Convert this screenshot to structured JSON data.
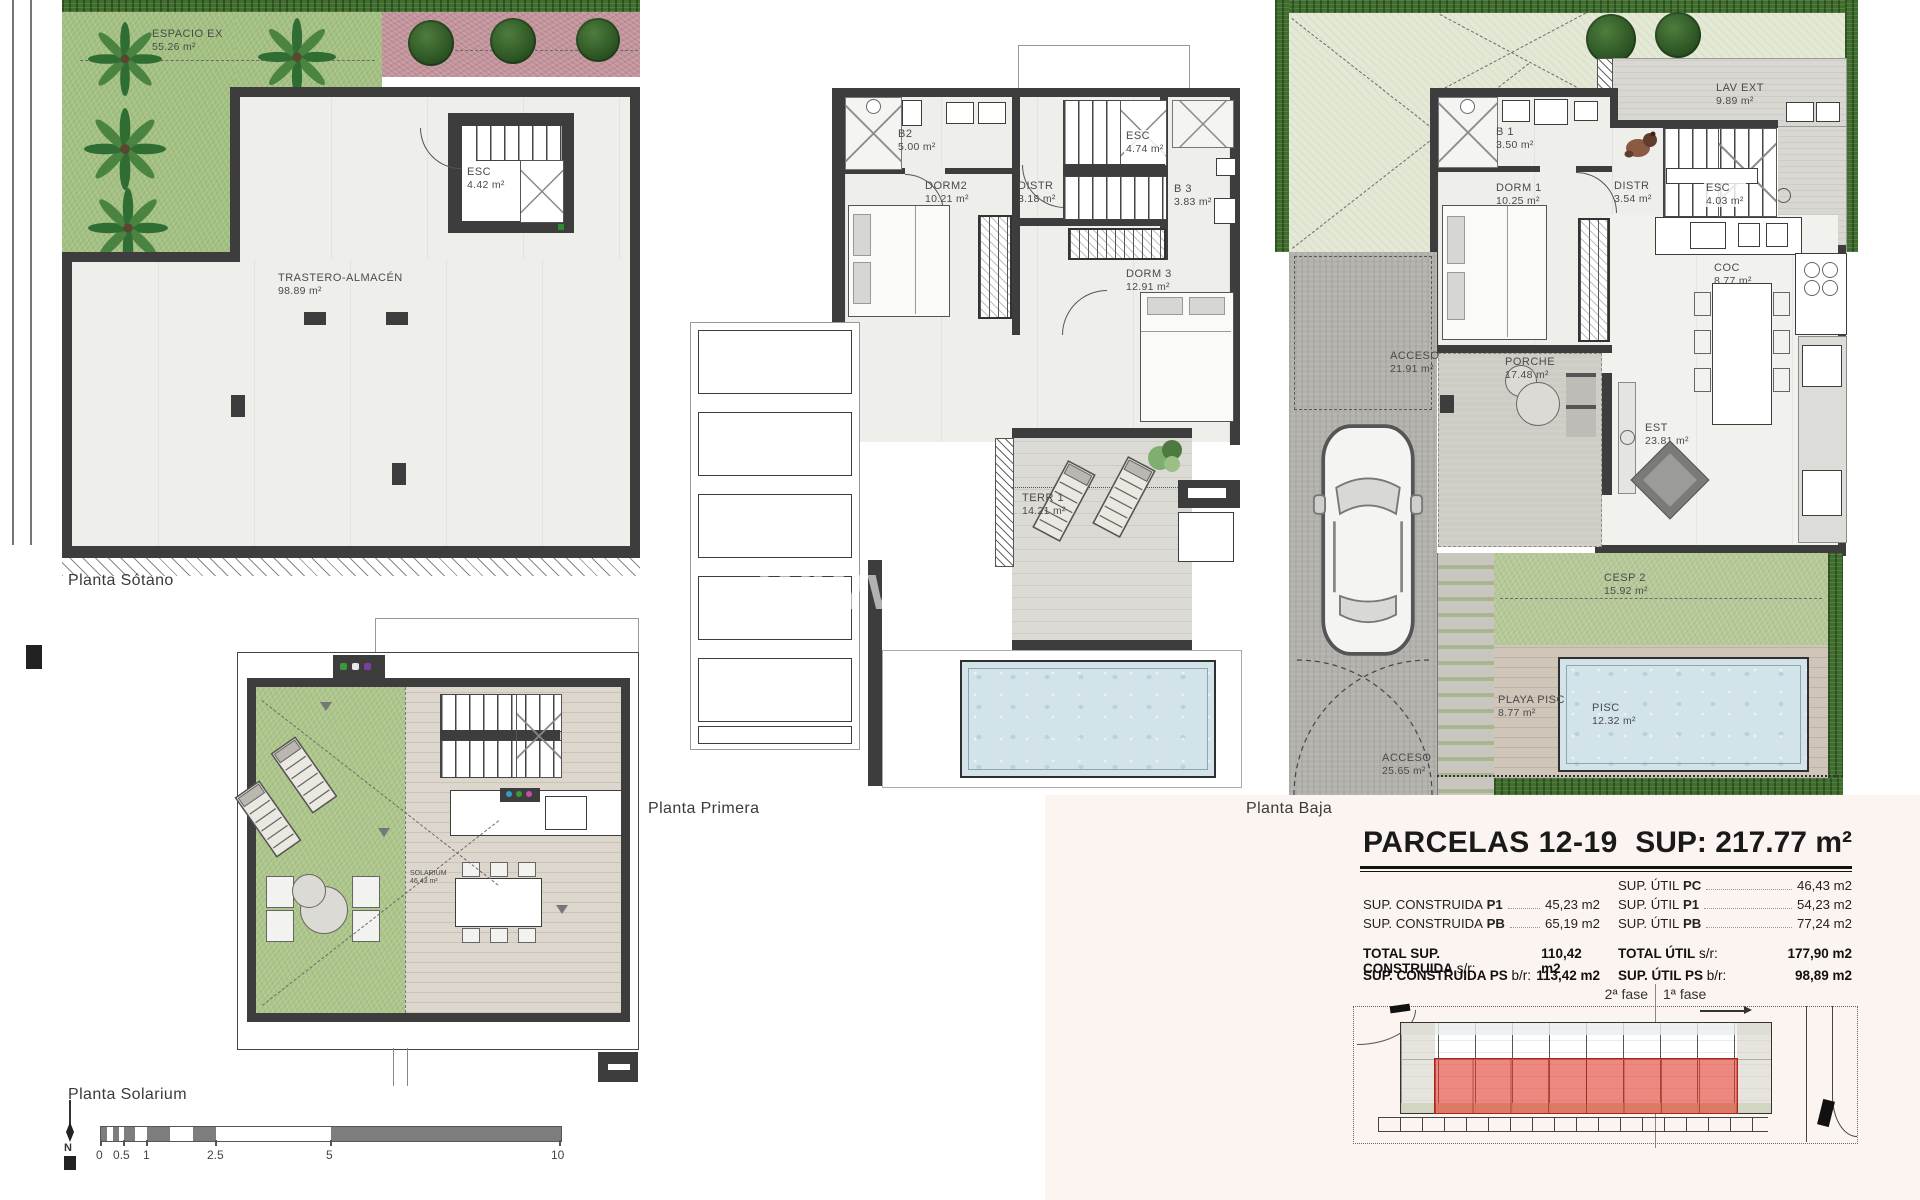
{
  "watermark": "www",
  "plans": {
    "sotano": {
      "title": "Planta Sótano",
      "rooms": {
        "espacio": {
          "name": "ESPACIO EX",
          "area": "55.26 m²"
        },
        "esc": {
          "name": "ESC",
          "area": "4.42 m²"
        },
        "trastero": {
          "name": "TRASTERO-ALMACÉN",
          "area": "98.89 m²"
        }
      }
    },
    "primera": {
      "title": "Planta Primera",
      "rooms": {
        "b2": {
          "name": "B2",
          "area": "5.00 m²"
        },
        "dorm2": {
          "name": "DORM2",
          "area": "10.21 m²"
        },
        "distr": {
          "name": "DISTR",
          "area": "3.18 m²"
        },
        "esc": {
          "name": "ESC",
          "area": "4.74 m²"
        },
        "b3": {
          "name": "B 3",
          "area": "3.83 m²"
        },
        "dorm3": {
          "name": "DORM 3",
          "area": "12.91 m²"
        },
        "terr1": {
          "name": "TERR 1",
          "area": "14.21 m²"
        }
      }
    },
    "baja": {
      "title": "Planta Baja",
      "rooms": {
        "lavext": {
          "name": "LAV EXT",
          "area": "9.89 m²"
        },
        "b1": {
          "name": "B 1",
          "area": "3.50 m²"
        },
        "dorm1": {
          "name": "DORM 1",
          "area": "10.25 m²"
        },
        "distr": {
          "name": "DISTR",
          "area": "3.54 m²"
        },
        "esc": {
          "name": "ESC",
          "area": "4.03 m²"
        },
        "coc": {
          "name": "COC",
          "area": "8.77 m²"
        },
        "acceso": {
          "name": "ACCESO",
          "area": "21.91 m²"
        },
        "porche": {
          "name": "PORCHE",
          "area": "17.48 m²"
        },
        "est": {
          "name": "EST",
          "area": "23.81 m²"
        },
        "cesp2": {
          "name": "CESP 2",
          "area": "15.92 m²"
        },
        "playa": {
          "name": "PLAYA PISC",
          "area": "8.77 m²"
        },
        "pisc": {
          "name": "PISC",
          "area": "12.32 m²"
        },
        "acceso2": {
          "name": "ACCESO",
          "area": "25.65 m²"
        }
      }
    },
    "solarium": {
      "title": "Planta Solarium",
      "rooms": {
        "solarium": {
          "name": "SOLARIUM",
          "area": "46.43 m²"
        }
      }
    }
  },
  "summary": {
    "title": "PARCELAS 12-19",
    "sup_total": "SUP: 217.77 m²",
    "left_rows": [
      {
        "label": "SUP. CONSTRUIDA",
        "key": "P1",
        "value": "45,23 m2"
      },
      {
        "label": "SUP. CONSTRUIDA",
        "key": "PB",
        "value": "65,19 m2"
      }
    ],
    "right_rows": [
      {
        "label": "SUP. ÚTIL",
        "key": "PC",
        "value": "46,43 m2"
      },
      {
        "label": "SUP. ÚTIL",
        "key": "P1",
        "value": "54,23 m2"
      },
      {
        "label": "SUP. ÚTIL",
        "key": "PB",
        "value": "77,24 m2"
      }
    ],
    "totals_left": [
      {
        "label": "TOTAL SUP. CONSTRUIDA",
        "key": "s/r:",
        "value": "110,42 m2"
      },
      {
        "label": "SUP. CONSTRUIDA PS",
        "key": "b/r:",
        "value": "113,42 m2"
      }
    ],
    "totals_right": [
      {
        "label": "TOTAL ÚTIL",
        "key": "s/r:",
        "value": "177,90 m2"
      },
      {
        "label": "SUP. ÚTIL PS",
        "key": "b/r:",
        "value": "98,89 m2"
      }
    ]
  },
  "site": {
    "fase2": "2ª fase",
    "fase1": "1ª fase"
  },
  "scalebar": {
    "ticks": [
      "0",
      "0.5",
      "1",
      "2.5",
      "5",
      "10"
    ],
    "north": "N"
  }
}
